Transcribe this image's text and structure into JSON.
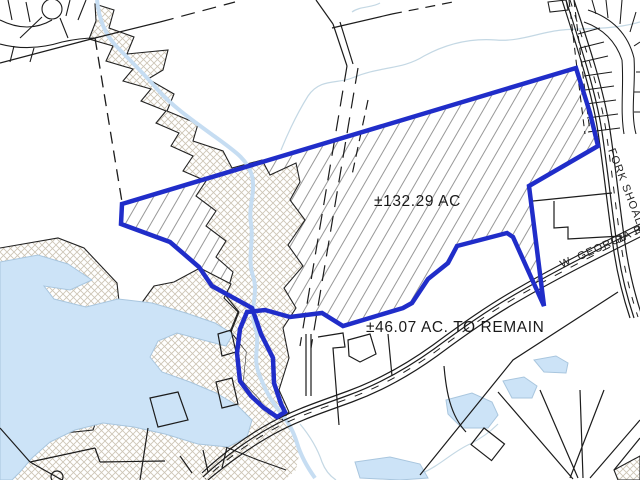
{
  "labels": {
    "parcel_primary_acreage": "±132.29 AC",
    "parcel_remainder_acreage": "±46.07 AC. TO REMAIN"
  },
  "roads": {
    "fork_shoals": "FORK SHOALS RD",
    "w_georgia": "W. GEORGIA RD"
  },
  "colors": {
    "boundary_blue": "#202dc9",
    "water_fill": "#cce3f7",
    "water_edge": "#a9c6de",
    "contour_line": "#c4d8e4",
    "crosshatch_line": "#cdc5b6",
    "diagonal_hatch_line": "#989898",
    "parcel_line": "#1c1c1c",
    "background": "#ffffff"
  }
}
